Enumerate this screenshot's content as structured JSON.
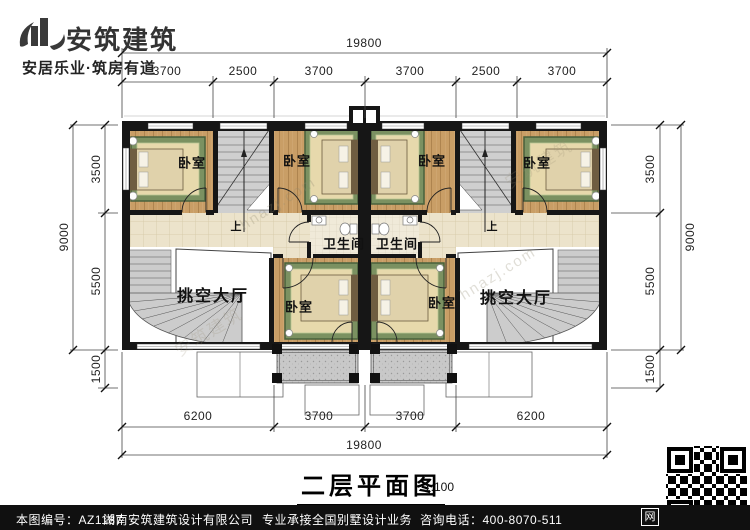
{
  "header": {
    "brand": "安筑建筑",
    "tagline": "安居乐业·筑房有道"
  },
  "title": {
    "text": "二层平面图",
    "scale": "1:100"
  },
  "plan": {
    "labels": [
      {
        "text": "卧室"
      },
      {
        "text": "卧室"
      },
      {
        "text": "卧室"
      },
      {
        "text": "卧室"
      },
      {
        "text": "卫生间"
      },
      {
        "text": "卫生间"
      },
      {
        "text": "挑空大厅"
      },
      {
        "text": "挑空大厅"
      },
      {
        "text": "卧室"
      },
      {
        "text": "卧室"
      },
      {
        "text": "上"
      },
      {
        "text": "上"
      }
    ],
    "dimensions": {
      "top": {
        "total": "19800",
        "segments": [
          "3700",
          "2500",
          "3700",
          "3700",
          "2500",
          "3700"
        ]
      },
      "bottom": {
        "total": "19800",
        "segments": [
          "6200",
          "3700",
          "3700",
          "6200"
        ]
      },
      "left": {
        "total": "9000",
        "segments": [
          "3500",
          "5500",
          "1500"
        ]
      },
      "right": {
        "total": "9000",
        "segments": [
          "3500",
          "5500",
          "1500"
        ]
      }
    },
    "watermark": "hnazj.com",
    "watermark2": "安筑建筑"
  },
  "footer": {
    "sheet_no": "本图编号：AZ1187",
    "company": "湖南安筑建筑设计有限公司",
    "service": "专业承接全国别墅设计业务",
    "phone": "咨询电话：400-8070-511",
    "web_icon": "网"
  }
}
